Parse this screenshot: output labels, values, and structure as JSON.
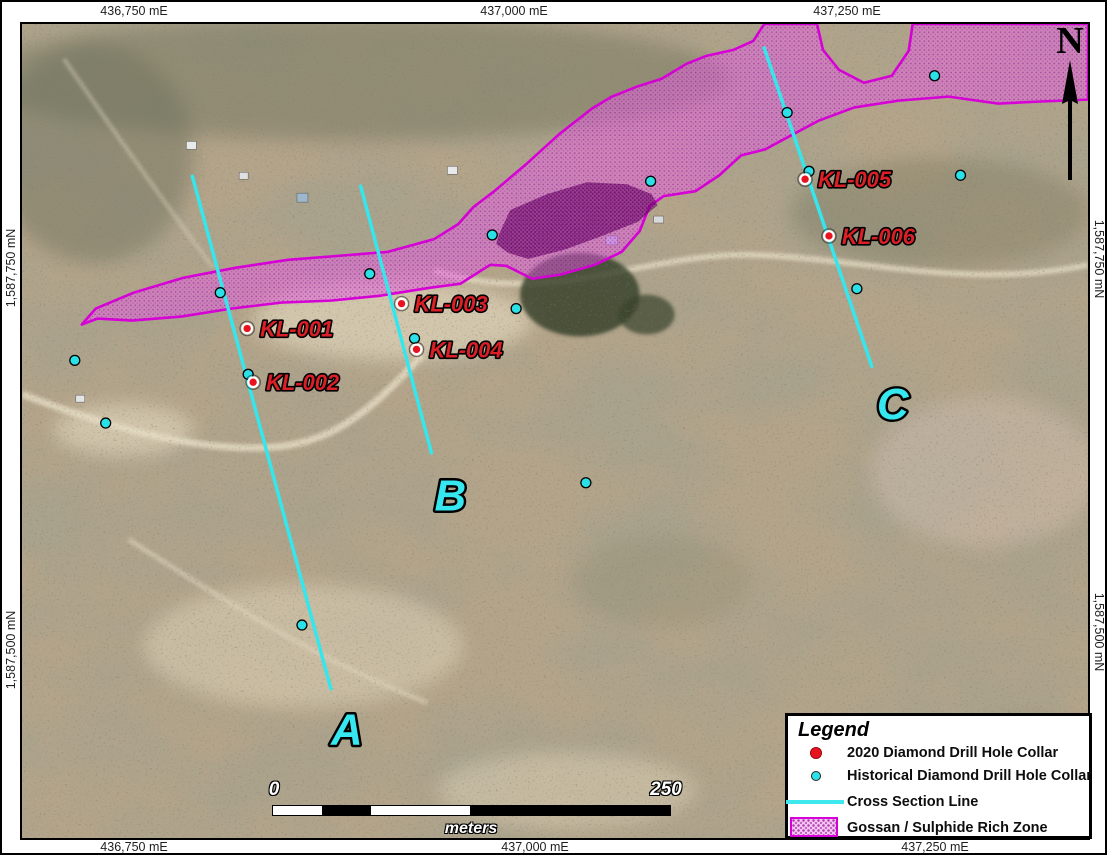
{
  "grid": {
    "top": [
      {
        "text": "436,750 mE",
        "x": 132
      },
      {
        "text": "437,000 mE",
        "x": 512
      },
      {
        "text": "437,250 mE",
        "x": 845
      }
    ],
    "bottom": [
      {
        "text": "436,750 mE",
        "x": 132
      },
      {
        "text": "437,000 mE",
        "x": 533
      },
      {
        "text": "437,250 mE",
        "x": 933
      }
    ],
    "left": [
      {
        "text": "1,587,750 mN",
        "y": 266
      },
      {
        "text": "1,587,500 mN",
        "y": 648
      }
    ],
    "right": [
      {
        "text": "1,587,750 mN",
        "y": 257
      },
      {
        "text": "1,587,500 mN",
        "y": 630
      }
    ]
  },
  "north_arrow": {
    "label": "N"
  },
  "scale_bar": {
    "zero": "0",
    "max": "250",
    "unit": "meters"
  },
  "legend": {
    "title": "Legend",
    "items": [
      {
        "symbol": "red-dot",
        "label": "2020 Diamond Drill Hole Collar"
      },
      {
        "symbol": "cyan-dot",
        "label": "Historical Diamond Drill Hole Collar"
      },
      {
        "symbol": "cyan-line",
        "label": "Cross Section Line"
      },
      {
        "symbol": "magenta-patch",
        "label": "Gossan / Sulphide Rich Zone"
      }
    ]
  },
  "colors": {
    "cyan": "#2ae1e8",
    "red": "#e8131f",
    "magenta_outline": "#d800d8",
    "magenta_fill": "#ed5ded",
    "label_red": "#da1f27",
    "section_label_cyan": "#36e7ef"
  },
  "map": {
    "cross_sections": [
      {
        "id": "A",
        "x1": 189,
        "y1": 173,
        "x2": 328,
        "y2": 688,
        "label_x": 344,
        "label_y": 744
      },
      {
        "id": "B",
        "x1": 358,
        "y1": 183,
        "x2": 429,
        "y2": 451,
        "label_x": 448,
        "label_y": 509
      },
      {
        "id": "C",
        "x1": 763,
        "y1": 44,
        "x2": 871,
        "y2": 364,
        "label_x": 892,
        "label_y": 417
      }
    ],
    "drill_holes_2020": [
      {
        "id": "KL-001",
        "x": 244,
        "y": 326
      },
      {
        "id": "KL-002",
        "x": 250,
        "y": 380
      },
      {
        "id": "KL-003",
        "x": 399,
        "y": 301
      },
      {
        "id": "KL-004",
        "x": 414,
        "y": 347
      },
      {
        "id": "KL-005",
        "x": 804,
        "y": 176
      },
      {
        "id": "KL-006",
        "x": 828,
        "y": 233
      }
    ],
    "historical_holes": [
      {
        "x": 71,
        "y": 358
      },
      {
        "x": 102,
        "y": 421
      },
      {
        "x": 217,
        "y": 290
      },
      {
        "x": 245,
        "y": 372
      },
      {
        "x": 299,
        "y": 624
      },
      {
        "x": 367,
        "y": 271
      },
      {
        "x": 412,
        "y": 336
      },
      {
        "x": 490,
        "y": 232
      },
      {
        "x": 514,
        "y": 306
      },
      {
        "x": 584,
        "y": 481
      },
      {
        "x": 649,
        "y": 178
      },
      {
        "x": 786,
        "y": 109
      },
      {
        "x": 808,
        "y": 168
      },
      {
        "x": 856,
        "y": 286
      },
      {
        "x": 934,
        "y": 72
      },
      {
        "x": 960,
        "y": 172
      }
    ],
    "gossan_zone": {
      "outer_points": "78,322 92,306 130,290 180,275 232,265 285,257 335,253 385,249 432,236 456,221 471,204 492,188 525,160 558,130 590,105 610,93 635,83 660,75 685,60 705,52 732,46 752,37 763,20 816,20 822,46 838,66 863,79 891,72 908,47 912,20 1088,20 1088,96 1038,98 998,100 948,93 898,97 853,104 818,117 788,133 764,146 740,152 718,172 694,188 662,193 648,203 638,228 620,249 593,262 558,272 530,276 504,263 488,262 458,281 428,285 378,293 328,298 278,300 228,306 178,314 128,318 94,316",
      "dark_patch_points": "497,231 508,207 545,191 585,179 625,181 650,191 656,202 636,219 600,233 562,247 526,256 506,250 494,241"
    }
  }
}
